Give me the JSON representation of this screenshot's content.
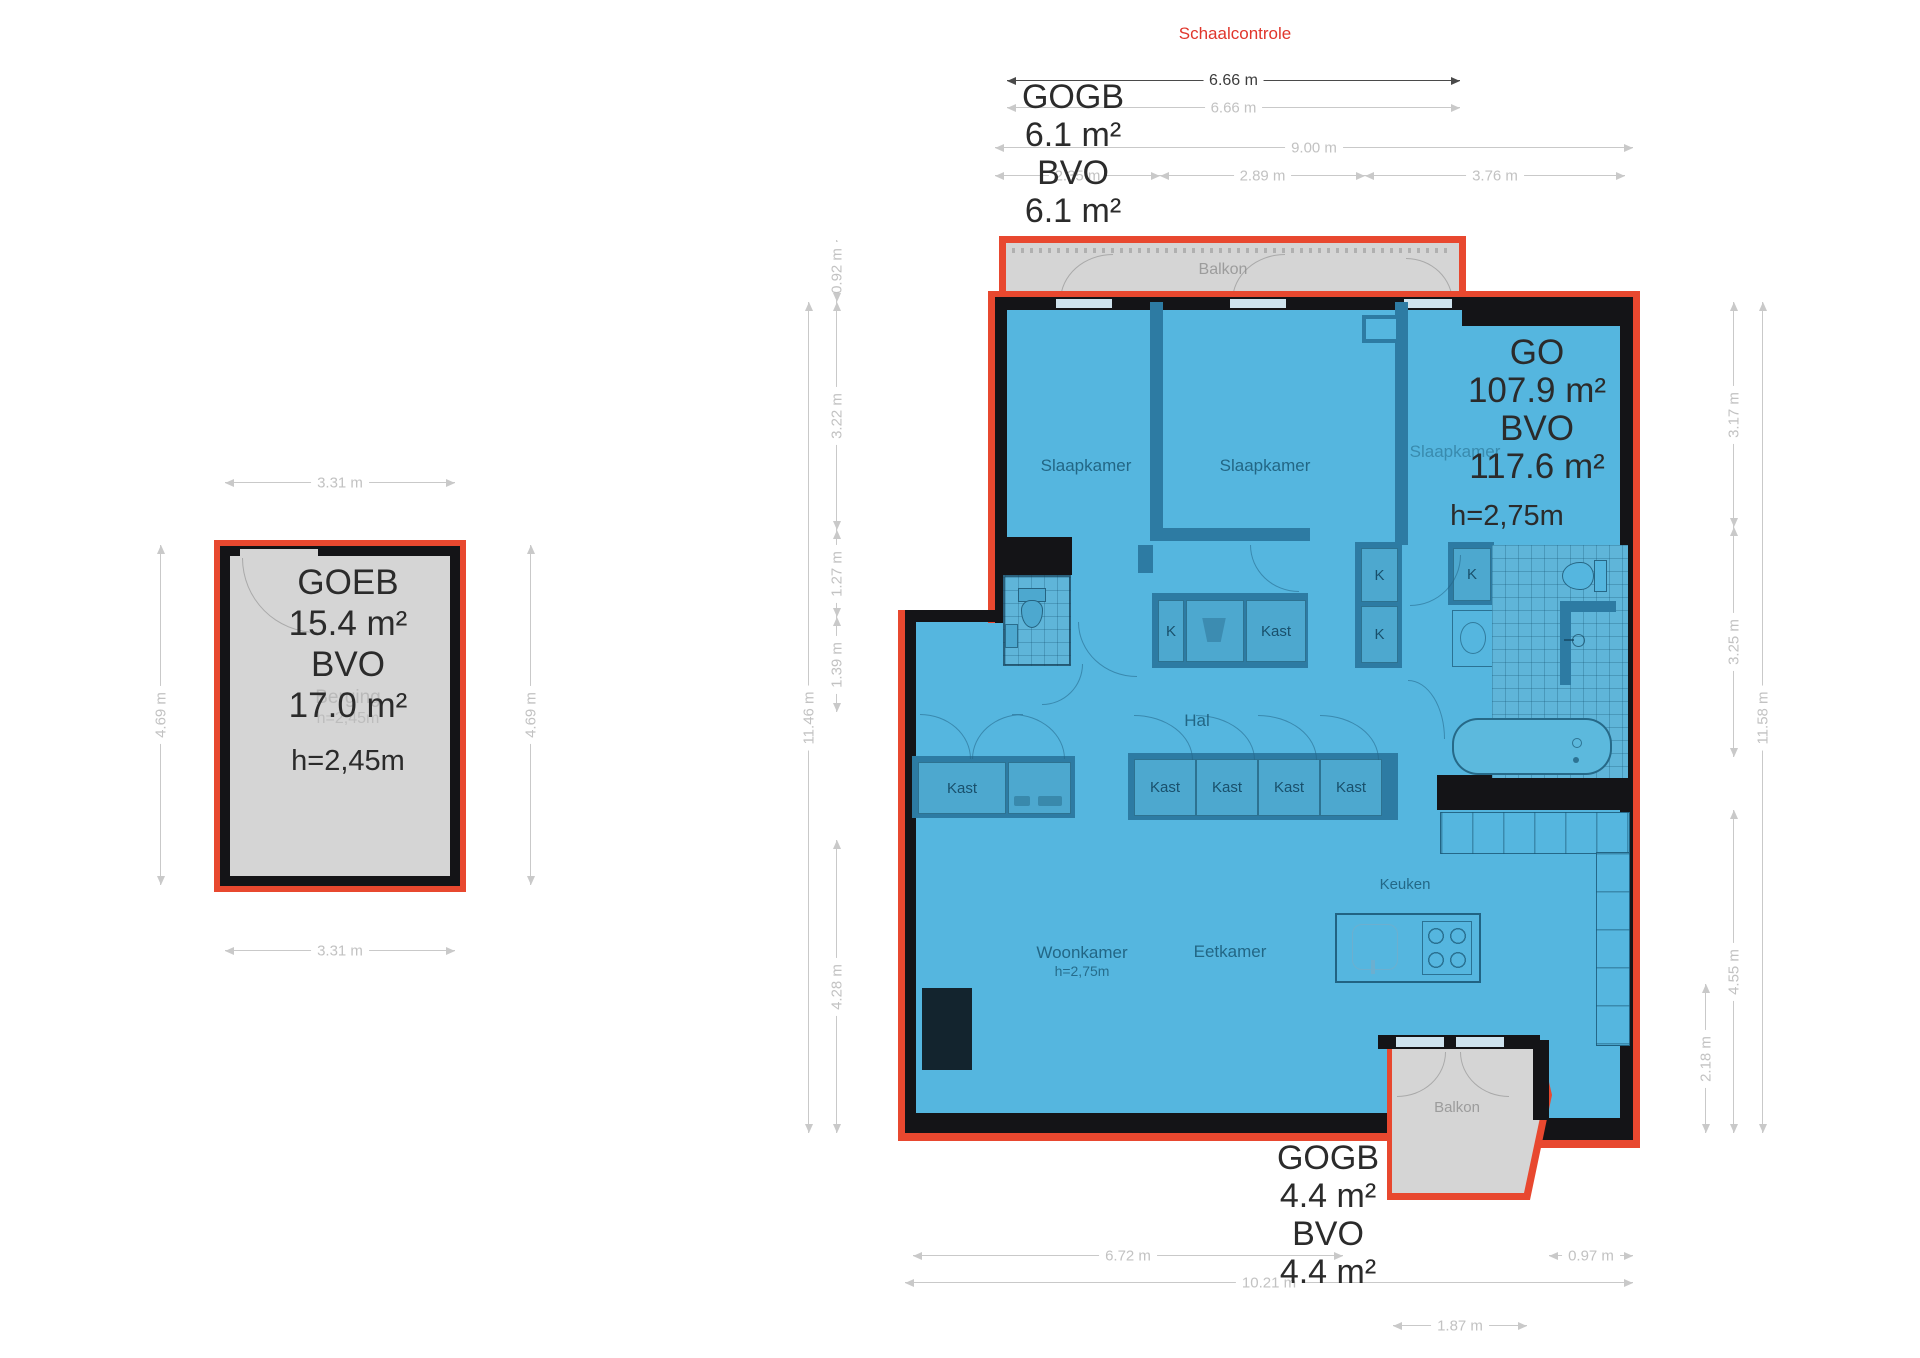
{
  "header": {
    "scale_check_label": "Schaalcontrole"
  },
  "berging": {
    "area_lines": [
      "GOEB",
      "15.4 m²",
      "BVO",
      "17.0 m²"
    ],
    "ceiling_height": "h=2,45m",
    "ghost_room": "Berging",
    "ghost_height": "h=2,45m",
    "dims": {
      "top": "3.31 m",
      "bottom": "3.31 m",
      "left": "4.69 m",
      "right": "4.69 m"
    }
  },
  "apartment": {
    "area_top_lines": [
      "GOGB",
      "6.1 m²",
      "BVO",
      "6.1 m²"
    ],
    "area_main_lines": [
      "GO",
      "107.9 m²",
      "BVO",
      "117.6 m²"
    ],
    "main_ceiling_height": "h=2,75m",
    "area_bottom_lines": [
      "GOGB",
      "4.4 m²",
      "BVO",
      "4.4 m²"
    ],
    "rooms": {
      "bedroom": "Slaapkamer",
      "hall": "Hal",
      "living": "Woonkamer",
      "living_height": "h=2,75m",
      "dining": "Eetkamer",
      "kitchen": "Keuken",
      "balcony": "Balkon",
      "closet": "Kast",
      "closet_small": "K"
    },
    "dims": {
      "scale_line": "6.66 m",
      "top_width": "6.66 m",
      "top_total": "9.00 m",
      "top_segments": [
        "2.35 m",
        "2.89 m",
        "3.76 m"
      ],
      "left_outer": "11.46 m",
      "left_segments": [
        "0.92 m",
        "3.22 m",
        "1.27 m",
        "1.39 m",
        "4.28 m"
      ],
      "right_outer": "11.58 m",
      "right_segments": [
        "3.17 m",
        "3.25 m",
        "4.55 m",
        "2.18 m"
      ],
      "bottom_living": "6.72 m",
      "bottom_total": "10.21 m",
      "bottom_right": "0.97 m",
      "bottom_balcony": "1.87 m"
    }
  },
  "colors": {
    "accent_red": "#e8482f",
    "floor_blue": "#55b6df",
    "wall_black": "#141417",
    "wall_blue": "#2d7ba3",
    "balcony_gray": "#d5d5d5",
    "dim_gray": "#c2c2c2"
  }
}
